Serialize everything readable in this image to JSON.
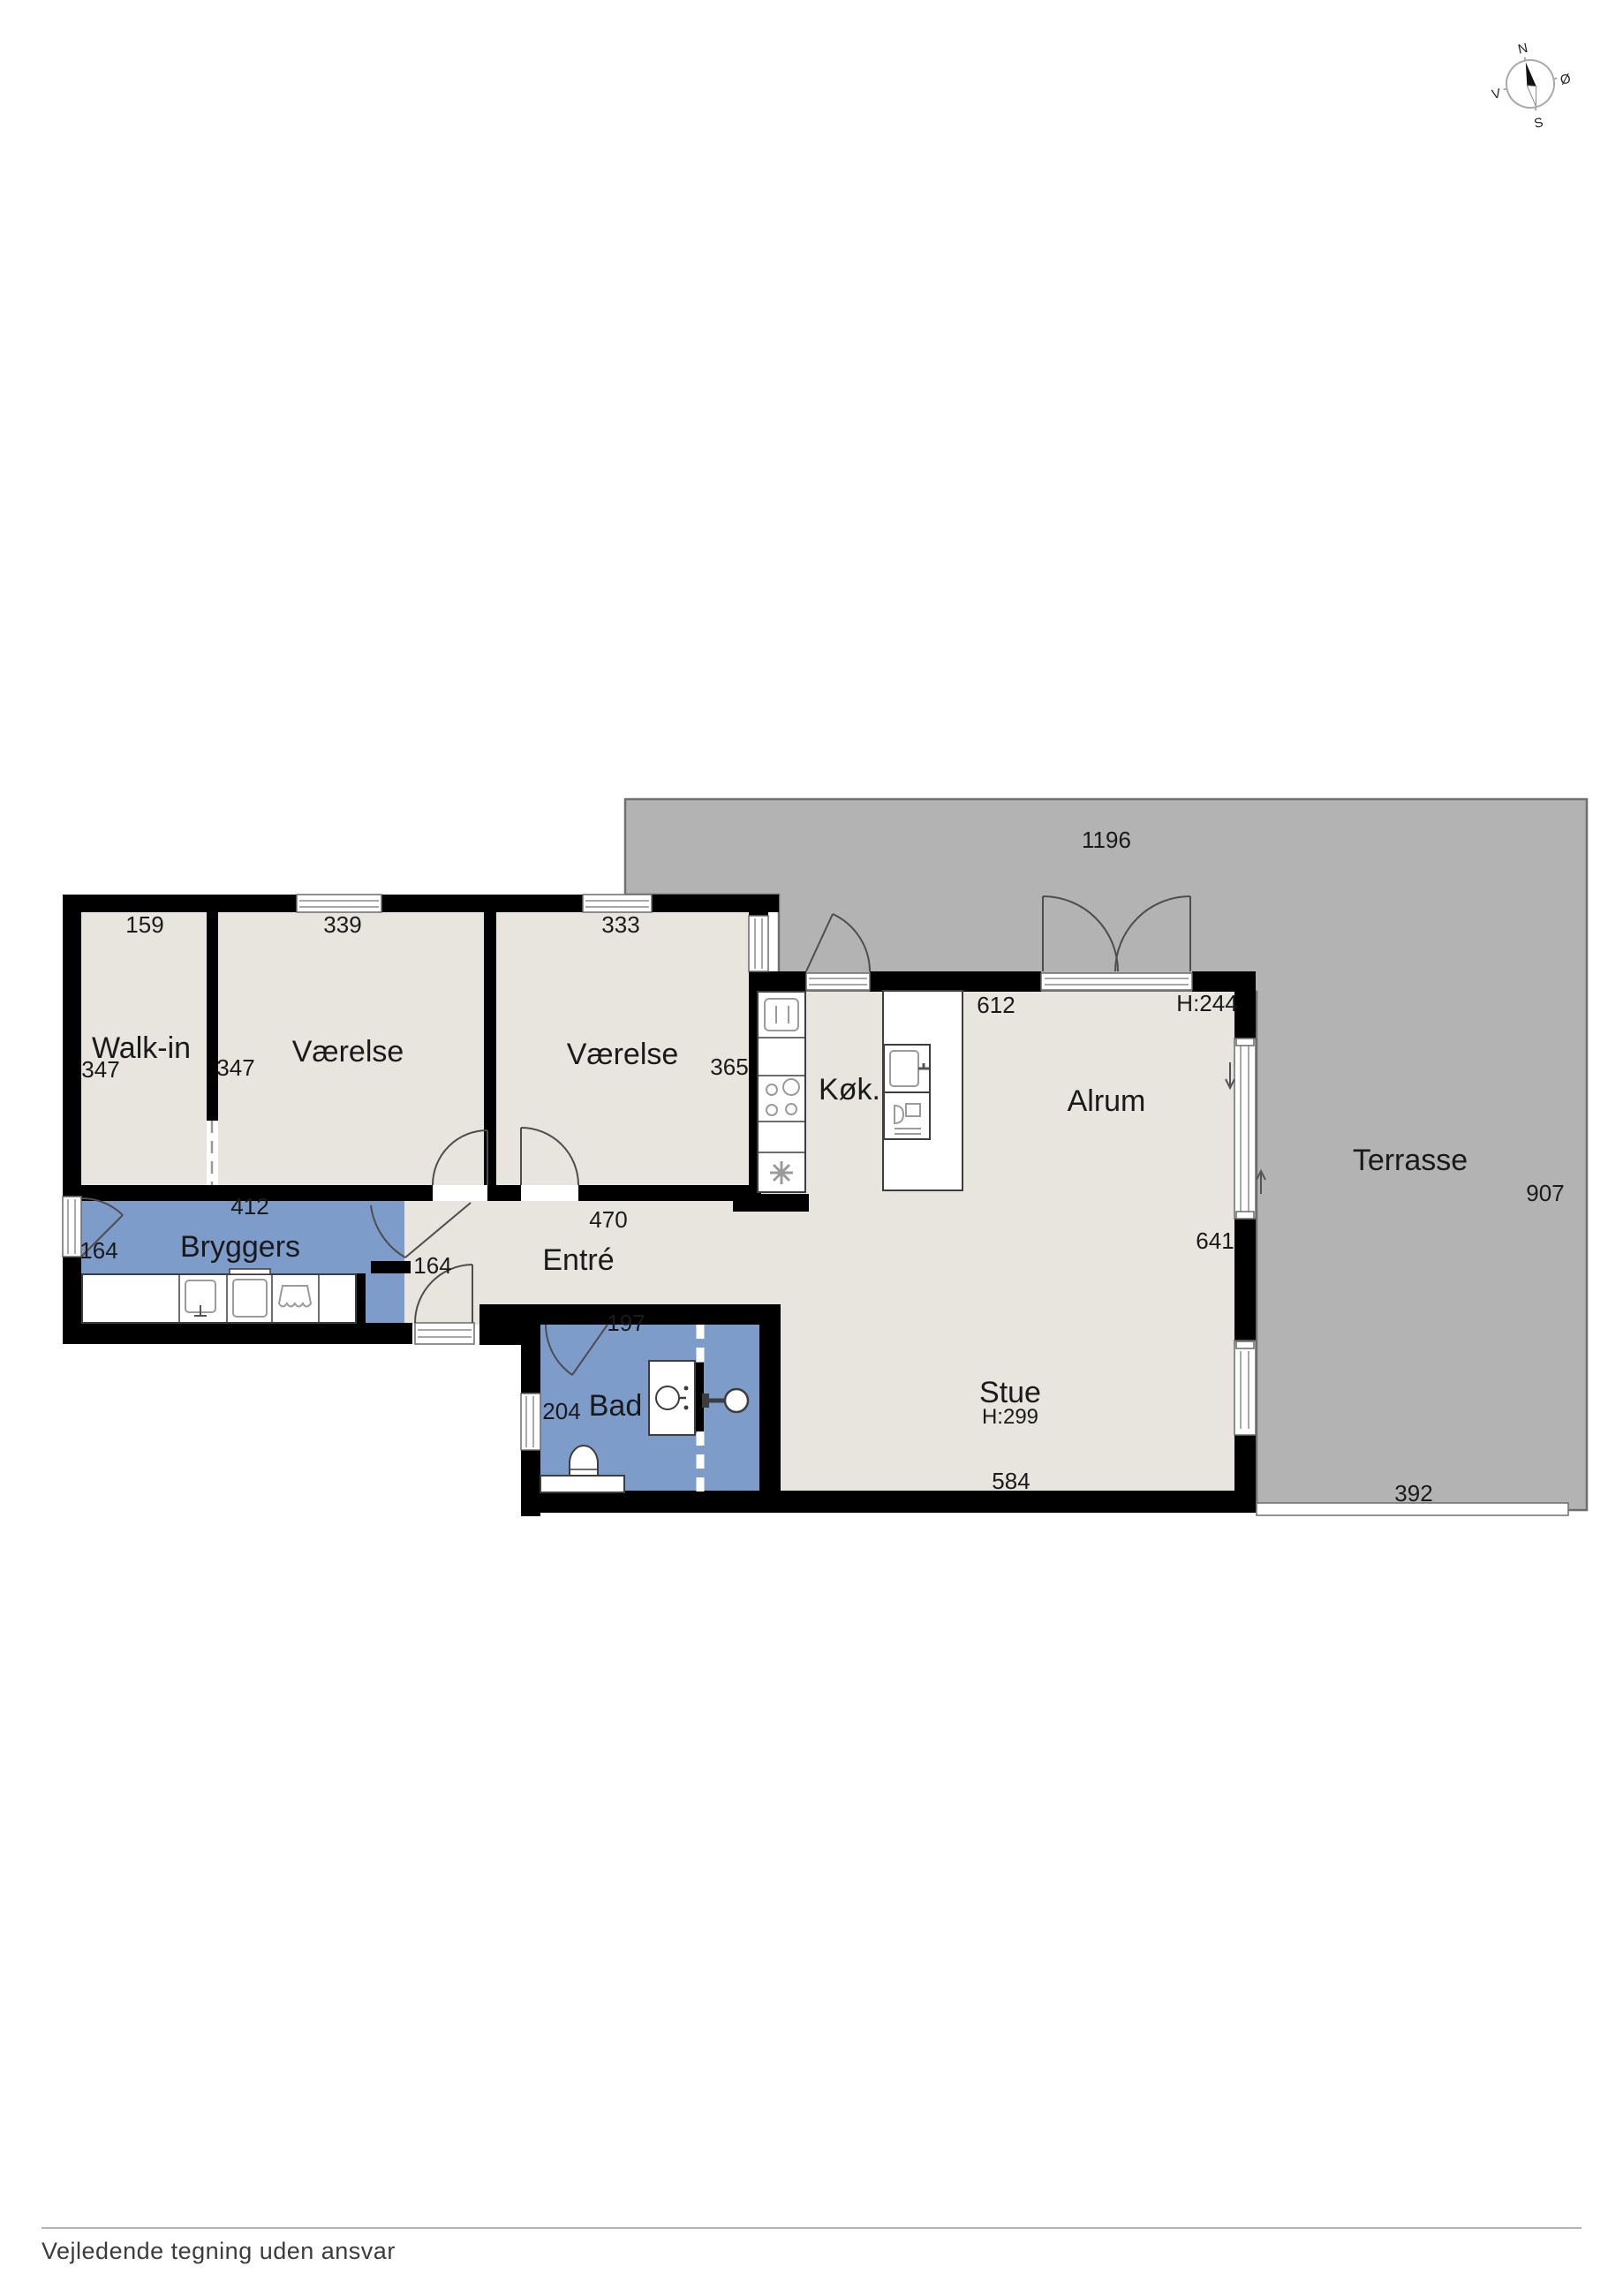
{
  "footer": {
    "note": "Vejledende tegning uden ansvar"
  },
  "compass": {
    "n": "N",
    "e": "Ø",
    "s": "S",
    "w": "V"
  },
  "colors": {
    "wall": "#000000",
    "floor": "#e8e4de",
    "wet_room": "#7d9cc9",
    "terrace": "#b3b3b3",
    "terrace_outline": "#6e6e6e",
    "fixture_outline": "#3d3d3d",
    "icon_gray": "#9b9b9b"
  },
  "rooms": {
    "walkin": {
      "label": "Walk-in",
      "width": "159",
      "depth": "347"
    },
    "vaerelse1": {
      "label": "Værelse",
      "width": "339",
      "depth": "347"
    },
    "vaerelse2": {
      "label": "Værelse",
      "width": "333",
      "depth": "365"
    },
    "koekken": {
      "label": "Køk."
    },
    "alrum": {
      "label": "Alrum",
      "width": "612",
      "ceiling": "H:244"
    },
    "bryggers": {
      "label": "Bryggers",
      "width": "412",
      "depth": "164",
      "opening": "164"
    },
    "entre": {
      "label": "Entré",
      "width": "470"
    },
    "bad": {
      "label": "Bad",
      "width": "197",
      "depth": "204"
    },
    "stue": {
      "label": "Stue",
      "width": "584",
      "ceiling": "H:299",
      "east": "641"
    },
    "terrasse": {
      "label": "Terrasse",
      "width": "1196",
      "depth": "907",
      "sill": "392"
    }
  }
}
